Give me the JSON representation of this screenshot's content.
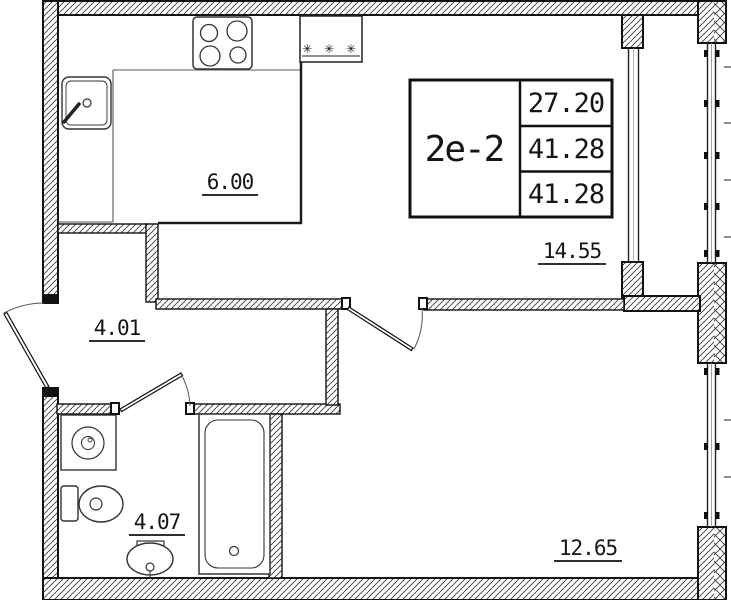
{
  "plan": {
    "unit_label": "2e-2",
    "info_values": [
      "27.20",
      "41.28",
      "41.28"
    ],
    "rooms": [
      {
        "name": "kitchen",
        "area": "6.00"
      },
      {
        "name": "living-room",
        "area": "14.55"
      },
      {
        "name": "hallway",
        "area": "4.01"
      },
      {
        "name": "bathroom",
        "area": "4.07"
      },
      {
        "name": "bedroom",
        "area": "12.65"
      }
    ],
    "vent_symbol": "✳ ✳ ✳",
    "colors": {
      "line": "#151515",
      "background": "#ffffff"
    }
  }
}
